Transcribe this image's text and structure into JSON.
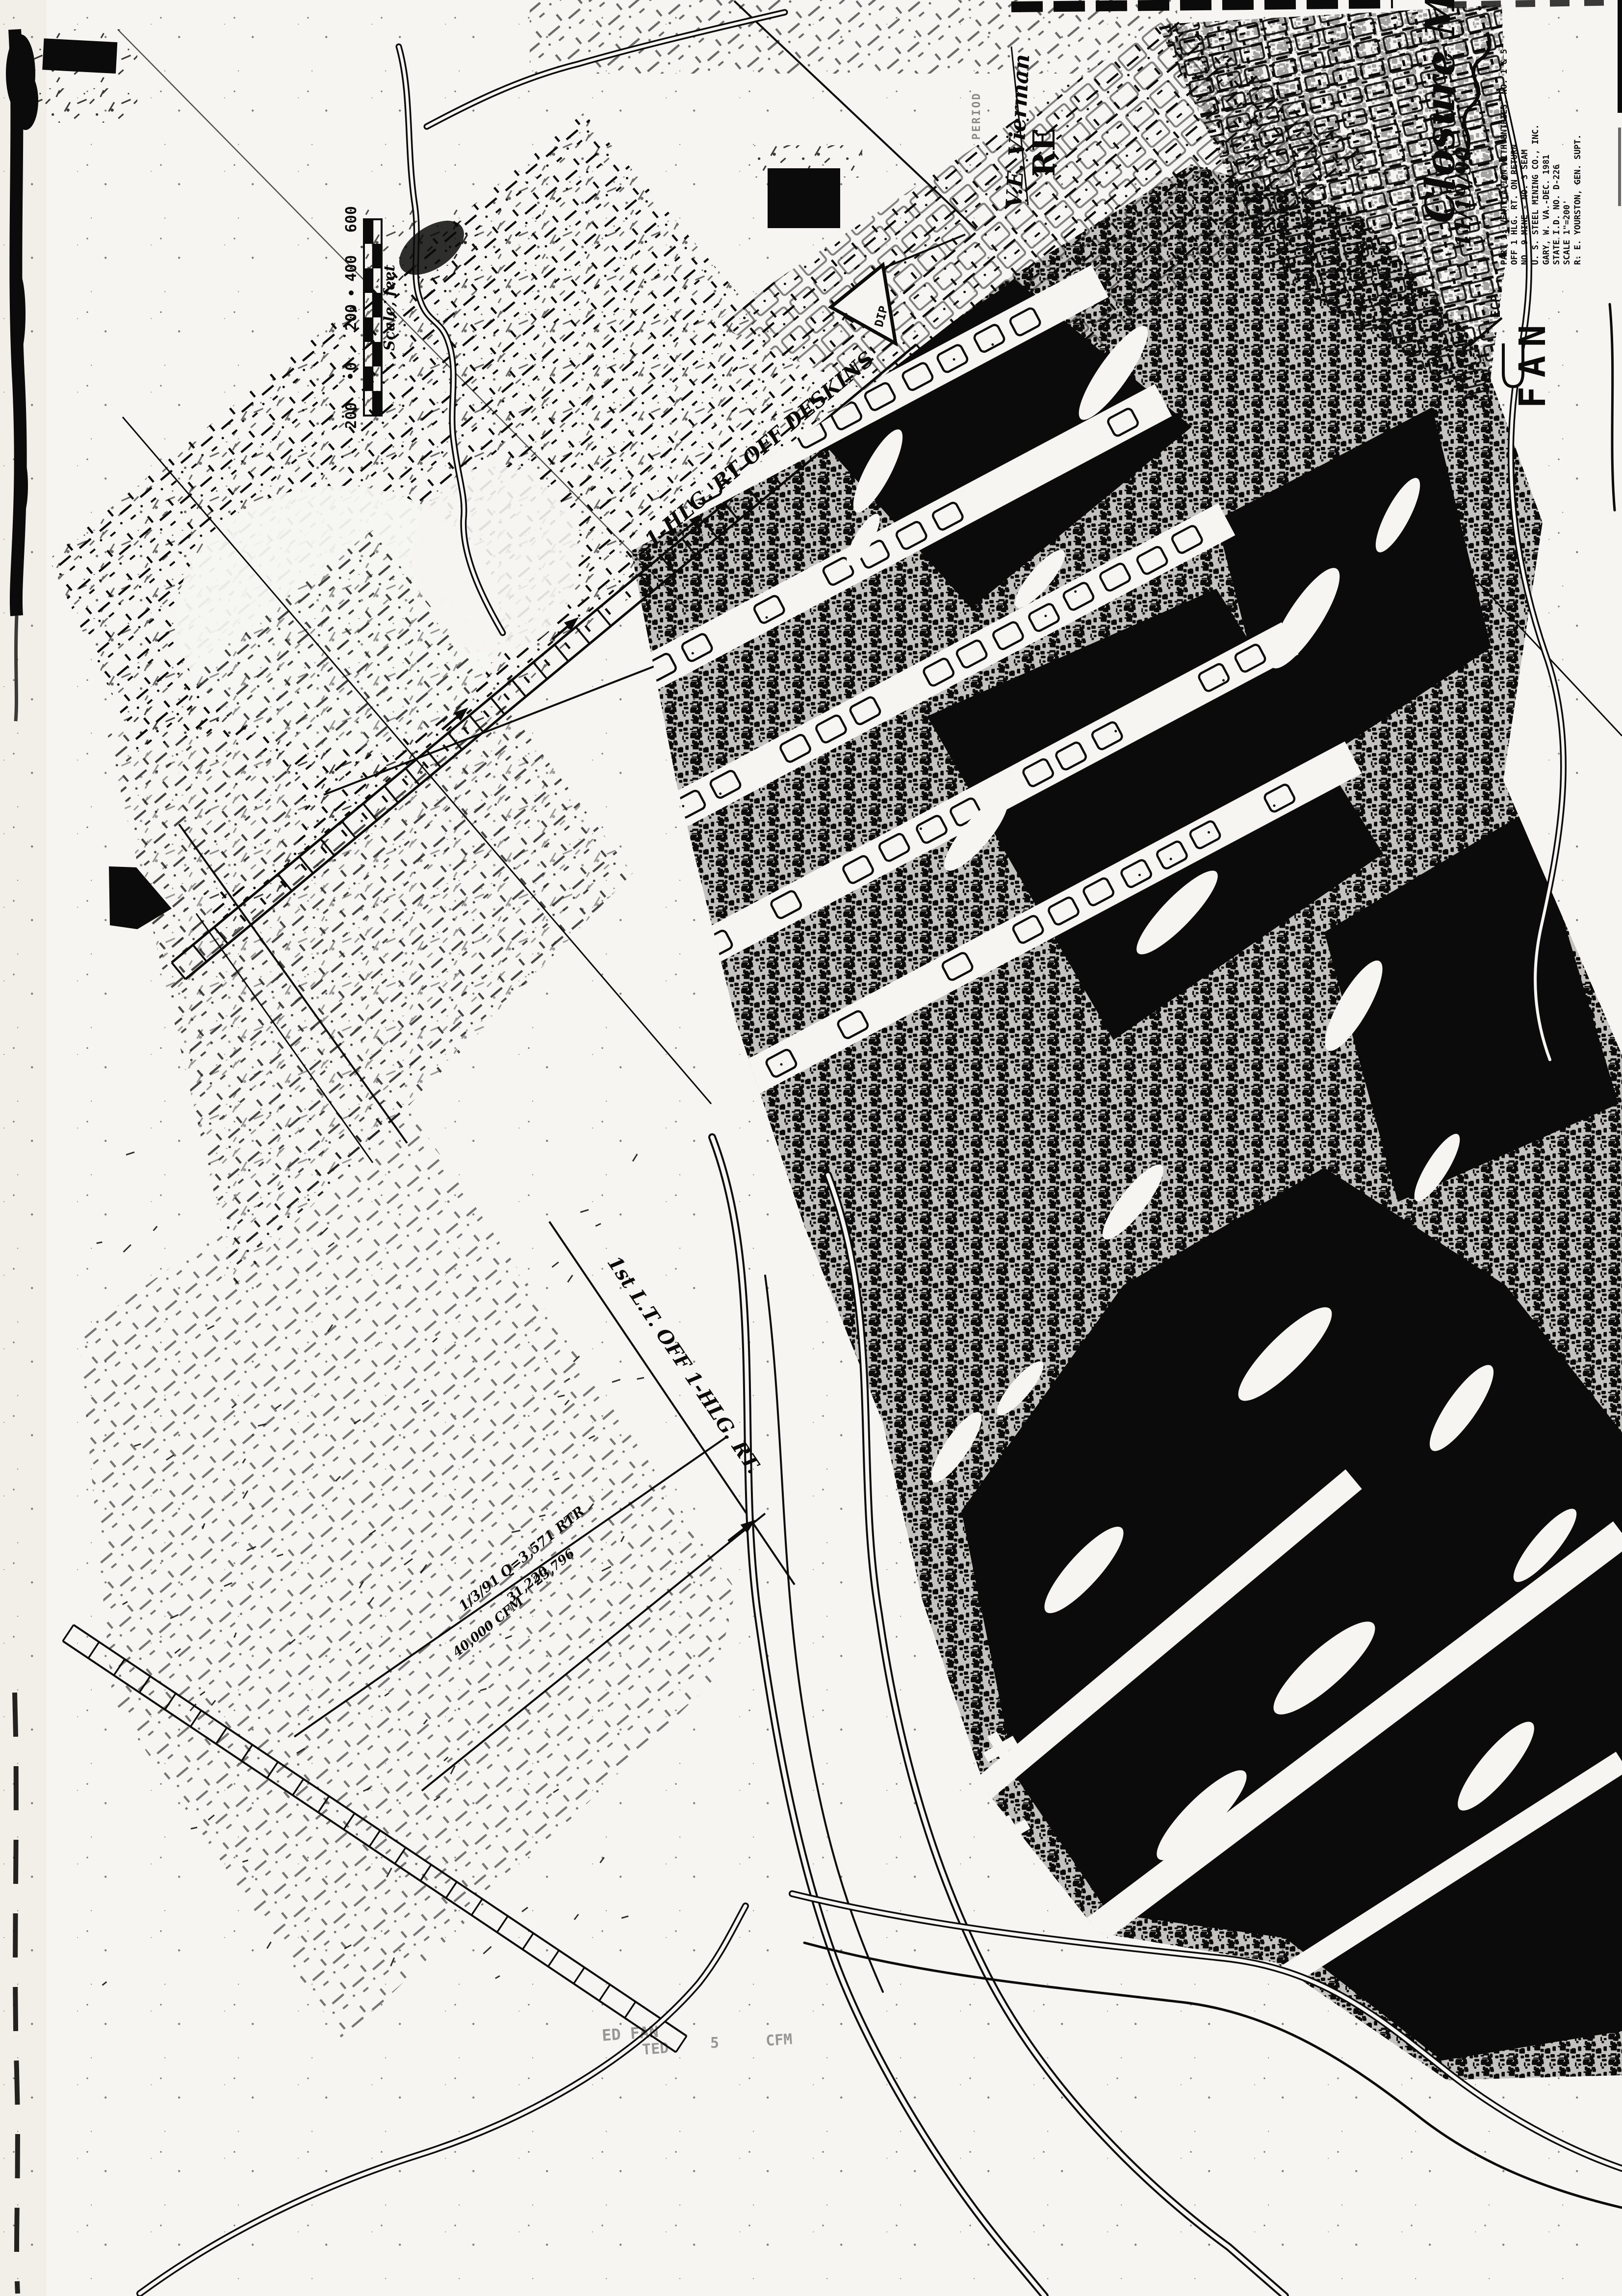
{
  "sheet": {
    "background": "#f6f5f1",
    "margin_band": "#f1efe8",
    "ink": "#0b0b0b",
    "sheet_number": "2"
  },
  "annotations": {
    "closure_title": "Closure Map",
    "closure_date": "11/19/90",
    "surveyor_signature": "V.E. Vierman",
    "stamp_partial": "RE",
    "faint_stamp": "PERIOD"
  },
  "title_block": {
    "prefix": "ECP:",
    "lines": [
      "PART 1: VENTILATION WITH ENTRIES, NO. 1 & 5",
      "OFF 1 HLG. RT. ON RETURN",
      "NO. 9 MINE - NO. 3 SEAM",
      "U. S. STEEL MINING CO., INC.",
      "GARY, W. VA.-DEC. 1981",
      "STATE I.D. NO. D-226",
      "SCALE 1\"=200'",
      "R. E. YOURSTON, GEN. SUPT."
    ]
  },
  "map_labels": {
    "heading_label": "1-HLG. RT OFF DESKINS",
    "left_turn_label": "1st L.T. OFF 1-HLG. RT.",
    "fan_label": "FAN",
    "dip_label": "DIP",
    "dip_symbol": "T",
    "vent_readings": [
      "1/3/91  Q=3,571  RTR",
      "31,220",
      "23,796",
      "40,000 CFM"
    ],
    "faint_fragments": [
      "ED FAN",
      "TED",
      "5",
      "CFM"
    ]
  },
  "scale_bar": {
    "labels_top_to_bottom": [
      "600",
      "400",
      "200",
      "0",
      "200"
    ],
    "caption": "Scale, feet"
  }
}
